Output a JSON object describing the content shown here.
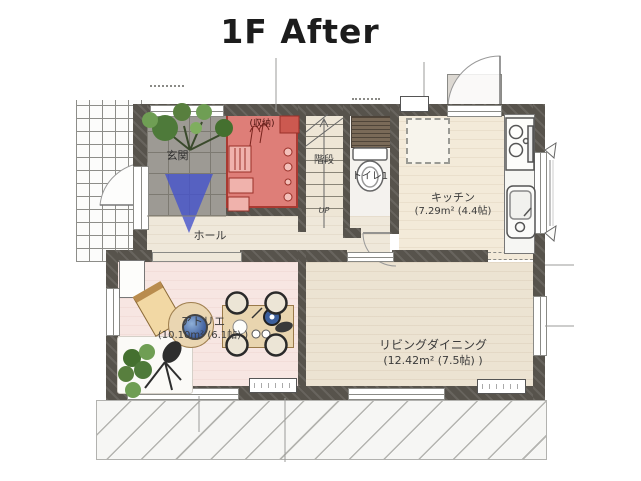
{
  "title": "1F After",
  "rooms": {
    "genkan": {
      "label": "玄関"
    },
    "hall": {
      "label": "ホール"
    },
    "closet": {
      "label": "(収納)"
    },
    "stairs": {
      "label": "階段",
      "direction": "UP"
    },
    "toilet": {
      "label": "トイレ1"
    },
    "kitchen": {
      "label": "キッチン",
      "area": "(7.29m² (4.4帖)"
    },
    "atelier": {
      "label": "アトリエ",
      "area": "(10.10m² (6.1帖) )"
    },
    "living": {
      "label": "リビングダイニング",
      "area": "(12.42m² (7.5帖) )"
    }
  },
  "colors": {
    "wall": "#57534c",
    "closet_highlight": "#de7e78",
    "closet_border": "#a93a32",
    "entry_arrow": "#4553cc",
    "genkan_tile": "#9d9a94",
    "wood_floor": "#ece3d2",
    "atelier_floor": "#f7e6e2",
    "plant_green": "#5d8a46"
  }
}
